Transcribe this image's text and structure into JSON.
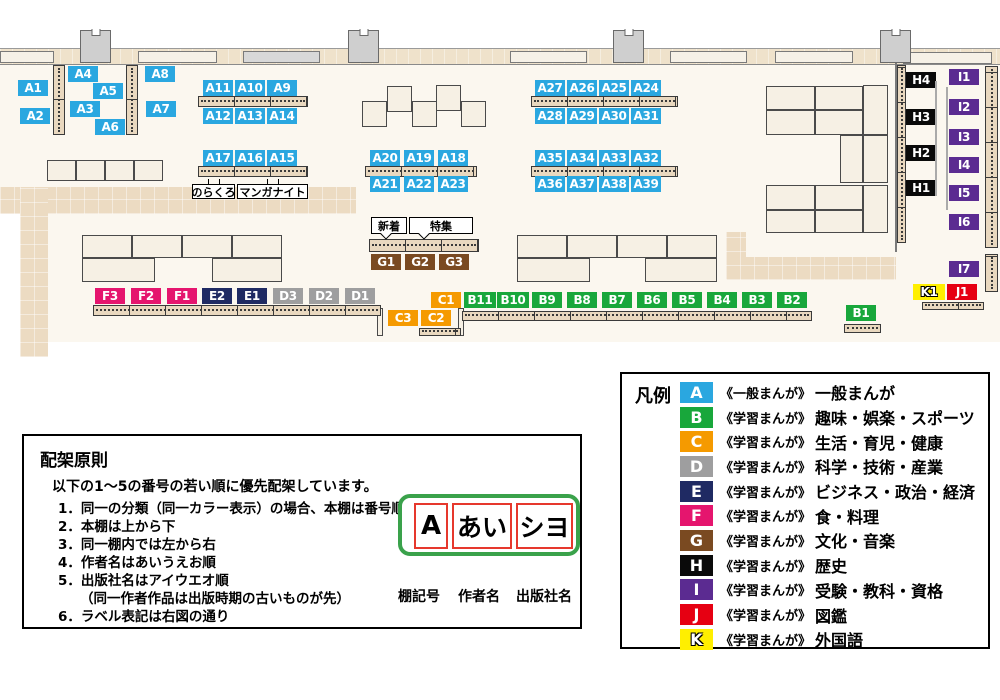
{
  "colors": {
    "A": "#2aa7e0",
    "B": "#18a73b",
    "C": "#f59a00",
    "D": "#9e9e9f",
    "E": "#1f2a63",
    "F": "#e5156e",
    "G": "#7a4a21",
    "H": "#0a0a0a",
    "I": "#5b2b91",
    "J": "#e60012",
    "K": "#ffef00"
  },
  "map": {
    "labels": [
      {
        "t": "A1",
        "x": 18,
        "y": 80
      },
      {
        "t": "A4",
        "x": 68,
        "y": 66
      },
      {
        "t": "A8",
        "x": 145,
        "y": 66
      },
      {
        "t": "A5",
        "x": 93,
        "y": 83
      },
      {
        "t": "A3",
        "x": 70,
        "y": 101
      },
      {
        "t": "A7",
        "x": 146,
        "y": 101
      },
      {
        "t": "A2",
        "x": 20,
        "y": 108
      },
      {
        "t": "A6",
        "x": 95,
        "y": 119
      },
      {
        "t": "A11",
        "x": 203,
        "y": 80
      },
      {
        "t": "A10",
        "x": 235,
        "y": 80
      },
      {
        "t": "A9",
        "x": 267,
        "y": 80
      },
      {
        "t": "A12",
        "x": 203,
        "y": 108
      },
      {
        "t": "A13",
        "x": 235,
        "y": 108
      },
      {
        "t": "A14",
        "x": 267,
        "y": 108
      },
      {
        "t": "A17",
        "x": 203,
        "y": 150
      },
      {
        "t": "A16",
        "x": 235,
        "y": 150
      },
      {
        "t": "A15",
        "x": 267,
        "y": 150
      },
      {
        "t": "A20",
        "x": 370,
        "y": 150
      },
      {
        "t": "A19",
        "x": 404,
        "y": 150
      },
      {
        "t": "A18",
        "x": 438,
        "y": 150
      },
      {
        "t": "A21",
        "x": 370,
        "y": 176
      },
      {
        "t": "A22",
        "x": 404,
        "y": 176
      },
      {
        "t": "A23",
        "x": 438,
        "y": 176
      },
      {
        "t": "A27",
        "x": 535,
        "y": 80
      },
      {
        "t": "A26",
        "x": 567,
        "y": 80
      },
      {
        "t": "A25",
        "x": 599,
        "y": 80
      },
      {
        "t": "A24",
        "x": 631,
        "y": 80
      },
      {
        "t": "A28",
        "x": 535,
        "y": 108
      },
      {
        "t": "A29",
        "x": 567,
        "y": 108
      },
      {
        "t": "A30",
        "x": 599,
        "y": 108
      },
      {
        "t": "A31",
        "x": 631,
        "y": 108
      },
      {
        "t": "A35",
        "x": 535,
        "y": 150
      },
      {
        "t": "A34",
        "x": 567,
        "y": 150
      },
      {
        "t": "A33",
        "x": 599,
        "y": 150
      },
      {
        "t": "A32",
        "x": 631,
        "y": 150
      },
      {
        "t": "A36",
        "x": 535,
        "y": 176
      },
      {
        "t": "A37",
        "x": 567,
        "y": 176
      },
      {
        "t": "A38",
        "x": 599,
        "y": 176
      },
      {
        "t": "A39",
        "x": 631,
        "y": 176
      },
      {
        "t": "G1",
        "x": 371,
        "y": 254
      },
      {
        "t": "G2",
        "x": 405,
        "y": 254
      },
      {
        "t": "G3",
        "x": 439,
        "y": 254
      },
      {
        "t": "F3",
        "x": 95,
        "y": 288
      },
      {
        "t": "F2",
        "x": 131,
        "y": 288
      },
      {
        "t": "F1",
        "x": 167,
        "y": 288
      },
      {
        "t": "E2",
        "x": 202,
        "y": 288
      },
      {
        "t": "E1",
        "x": 237,
        "y": 288
      },
      {
        "t": "D3",
        "x": 273,
        "y": 288
      },
      {
        "t": "D2",
        "x": 309,
        "y": 288
      },
      {
        "t": "D1",
        "x": 345,
        "y": 288
      },
      {
        "t": "C1",
        "x": 431,
        "y": 292
      },
      {
        "t": "B11",
        "x": 464,
        "y": 292,
        "w": 32
      },
      {
        "t": "B10",
        "x": 497,
        "y": 292,
        "w": 32
      },
      {
        "t": "B9",
        "x": 532,
        "y": 292
      },
      {
        "t": "B8",
        "x": 567,
        "y": 292
      },
      {
        "t": "B7",
        "x": 602,
        "y": 292
      },
      {
        "t": "B6",
        "x": 637,
        "y": 292
      },
      {
        "t": "B5",
        "x": 672,
        "y": 292
      },
      {
        "t": "B4",
        "x": 707,
        "y": 292
      },
      {
        "t": "B3",
        "x": 742,
        "y": 292
      },
      {
        "t": "B2",
        "x": 777,
        "y": 292
      },
      {
        "t": "C3",
        "x": 388,
        "y": 310
      },
      {
        "t": "C2",
        "x": 421,
        "y": 310
      },
      {
        "t": "B1",
        "x": 846,
        "y": 305
      },
      {
        "t": "H4",
        "x": 906,
        "y": 72
      },
      {
        "t": "H3",
        "x": 906,
        "y": 109
      },
      {
        "t": "H2",
        "x": 906,
        "y": 145
      },
      {
        "t": "H1",
        "x": 906,
        "y": 180
      },
      {
        "t": "I1",
        "x": 949,
        "y": 69
      },
      {
        "t": "I2",
        "x": 949,
        "y": 99
      },
      {
        "t": "I3",
        "x": 949,
        "y": 129
      },
      {
        "t": "I4",
        "x": 949,
        "y": 157
      },
      {
        "t": "I5",
        "x": 949,
        "y": 185
      },
      {
        "t": "I6",
        "x": 949,
        "y": 214
      },
      {
        "t": "I7",
        "x": 949,
        "y": 261
      },
      {
        "t": "K1",
        "x": 913,
        "y": 284,
        "w": 32
      },
      {
        "t": "J1",
        "x": 947,
        "y": 284
      }
    ],
    "callouts": [
      {
        "t": "のらくろ",
        "x": 192,
        "y": 184,
        "w": 43,
        "h": 15,
        "dir": "up"
      },
      {
        "t": "マンガナイト",
        "x": 237,
        "y": 184,
        "w": 71,
        "h": 15,
        "dir": "up"
      },
      {
        "t": "新着",
        "x": 371,
        "y": 217,
        "w": 36,
        "h": 17,
        "dir": "down"
      },
      {
        "t": "特集",
        "x": 409,
        "y": 217,
        "w": 64,
        "h": 17,
        "dir": "down"
      }
    ]
  },
  "legend": {
    "title": "凡例",
    "rows": [
      {
        "letter": "A",
        "prefix": "《一般まんが》",
        "name": "一般まんが"
      },
      {
        "letter": "B",
        "prefix": "《学習まんが》",
        "name": "趣味・娯楽・スポーツ"
      },
      {
        "letter": "C",
        "prefix": "《学習まんが》",
        "name": "生活・育児・健康"
      },
      {
        "letter": "D",
        "prefix": "《学習まんが》",
        "name": "科学・技術・産業"
      },
      {
        "letter": "E",
        "prefix": "《学習まんが》",
        "name": "ビジネス・政治・経済"
      },
      {
        "letter": "F",
        "prefix": "《学習まんが》",
        "name": "食・料理"
      },
      {
        "letter": "G",
        "prefix": "《学習まんが》",
        "name": "文化・音楽"
      },
      {
        "letter": "H",
        "prefix": "《学習まんが》",
        "name": "歴史"
      },
      {
        "letter": "I",
        "prefix": "《学習まんが》",
        "name": "受験・教科・資格"
      },
      {
        "letter": "J",
        "prefix": "《学習まんが》",
        "name": "図鑑"
      },
      {
        "letter": "K",
        "prefix": "《学習まんが》",
        "name": "外国語"
      }
    ]
  },
  "principles": {
    "title": "配架原則",
    "intro": "以下の1～5の番号の若い順に優先配架しています。",
    "items": [
      {
        "num": "1",
        "text": "同一の分類（同一カラー表示）の場合、本棚は番号順"
      },
      {
        "num": "2",
        "text": "本棚は上から下"
      },
      {
        "num": "3",
        "text": "同一棚内では左から右"
      },
      {
        "num": "4",
        "text": "作者名はあいうえお順"
      },
      {
        "num": "5",
        "text": "出版社名はアイウエオ順",
        "note": "（同一作者作品は出版時期の古いものが先）"
      },
      {
        "num": "6",
        "text": "ラベル表記は右図の通り"
      }
    ],
    "diagram": {
      "segments": [
        {
          "text": "A",
          "caption": "棚記号"
        },
        {
          "text": "あい",
          "caption": "作者名"
        },
        {
          "text": "シヨ",
          "caption": "出版社名"
        }
      ]
    }
  }
}
